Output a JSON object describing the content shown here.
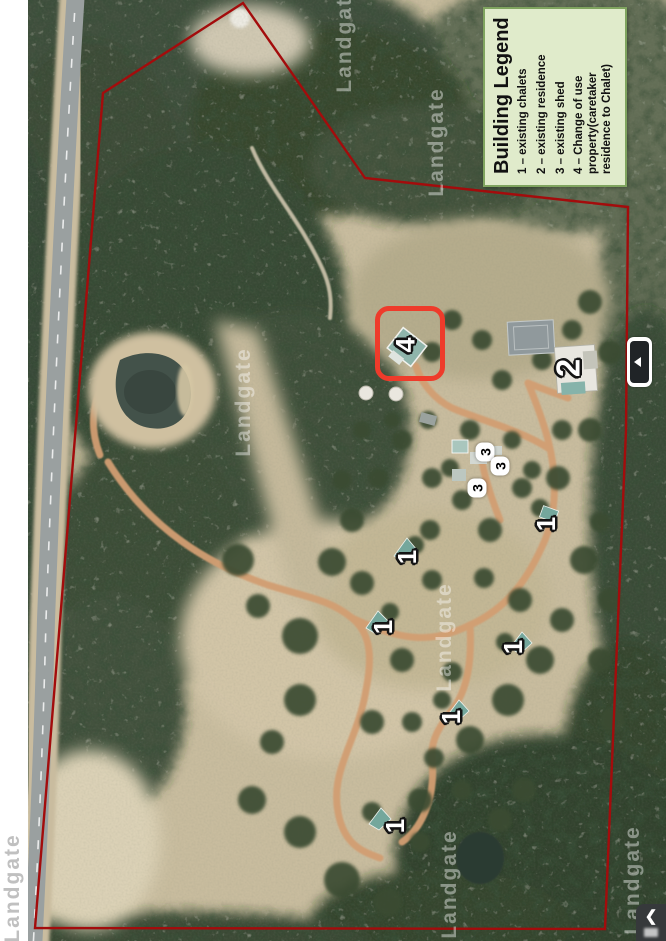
{
  "map": {
    "watermark_text": "Landgate",
    "boundary_color": "#a30c0c",
    "highlight_color": "#ee3b2b",
    "highlight": {
      "x": 375,
      "y": 306,
      "width": 70,
      "height": 75
    }
  },
  "legend": {
    "title": "Building Legend",
    "items": [
      {
        "key": "1",
        "text": "1 – existing chalets"
      },
      {
        "key": "2",
        "text": "2 – existing residence"
      },
      {
        "key": "3",
        "text": "3 – existing shed"
      },
      {
        "key": "4",
        "text": "4 – Change of use property(caretaker residence to Chalet)"
      }
    ],
    "background": "#e0ebcb",
    "border_color": "#7fa45f"
  },
  "markers": [
    {
      "label": "1",
      "meaning": "existing chalet",
      "x": 407,
      "y": 557,
      "style": "outline",
      "size": 26
    },
    {
      "label": "1",
      "meaning": "existing chalet",
      "x": 383,
      "y": 627,
      "style": "outline",
      "size": 26
    },
    {
      "label": "1",
      "meaning": "existing chalet",
      "x": 546,
      "y": 524,
      "style": "outline",
      "size": 26
    },
    {
      "label": "1",
      "meaning": "existing chalet",
      "x": 513,
      "y": 647,
      "style": "outline",
      "size": 26
    },
    {
      "label": "1",
      "meaning": "existing chalet",
      "x": 451,
      "y": 717,
      "style": "outline",
      "size": 26
    },
    {
      "label": "1",
      "meaning": "existing chalet",
      "x": 395,
      "y": 826,
      "style": "outline",
      "size": 26
    },
    {
      "label": "2",
      "meaning": "existing residence",
      "x": 568,
      "y": 368,
      "style": "outline",
      "size": 33
    },
    {
      "label": "3",
      "meaning": "existing shed",
      "x": 485,
      "y": 452,
      "style": "pill",
      "size": 14
    },
    {
      "label": "3",
      "meaning": "existing shed",
      "x": 500,
      "y": 466,
      "style": "pill",
      "size": 14
    },
    {
      "label": "3",
      "meaning": "existing shed",
      "x": 477,
      "y": 488,
      "style": "pill",
      "size": 14
    },
    {
      "label": "4",
      "meaning": "change of use property (caretaker residence to chalet)",
      "x": 406,
      "y": 345,
      "style": "outline",
      "size": 27
    }
  ],
  "watermarks": [
    {
      "x": 244,
      "y": 402,
      "variant": "white"
    },
    {
      "x": 445,
      "y": 637,
      "variant": "white"
    },
    {
      "x": 345,
      "y": 38,
      "variant": "white"
    },
    {
      "x": 437,
      "y": 142,
      "variant": "white"
    },
    {
      "x": 450,
      "y": 884,
      "variant": "white"
    },
    {
      "x": 633,
      "y": 880,
      "variant": "white"
    },
    {
      "x": 13,
      "y": 888,
      "variant": "gray"
    }
  ],
  "ui": {
    "panel_toggle_icon": "triangle-left",
    "corner_tab_icon": "chevron-left",
    "corner_tab_chevron": "❮"
  }
}
